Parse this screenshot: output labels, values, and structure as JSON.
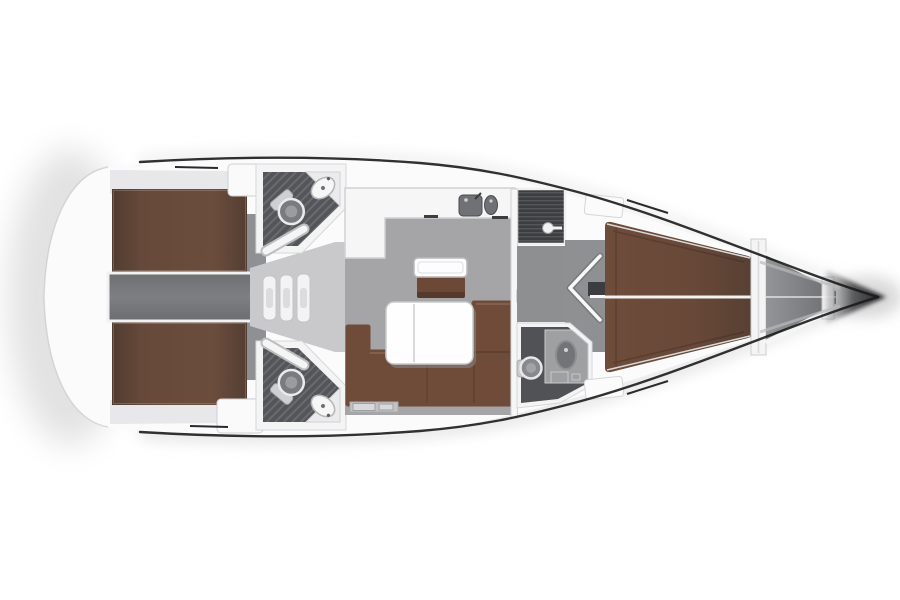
{
  "diagram": {
    "type": "yacht-interior-floor-plan",
    "view": "top-down",
    "bow_direction": "right",
    "rooms": [
      "aft-cabin-port",
      "aft-cabin-starboard",
      "engine-bay",
      "companionway",
      "aft-head-port",
      "aft-head-starboard",
      "salon",
      "galley",
      "forward-head",
      "forward-cabin",
      "anchor-locker"
    ],
    "furniture": [
      "double-berth-aft-port",
      "double-berth-aft-starboard",
      "companionway-steps",
      "toilet",
      "washbasin",
      "galley-sinks",
      "salon-sofa",
      "folding-table",
      "nav-seat",
      "v-berth-forward",
      "cabin-door-open"
    ]
  },
  "colors": {
    "background": "#ffffff",
    "hull": "#fbfbfc",
    "wall": "#f4f4f5",
    "wall_stroke": "#cfd0d2",
    "outline": "#1b1b1b",
    "salon_floor": "#a5a4a6",
    "landing_floor": "#c9c9cb",
    "engine_bay": "#77787b",
    "vestibule_floor": "#8e8f91",
    "forward_floor": "#8f9092",
    "head_floor": "#515255",
    "shower_floor": "#3d3e40",
    "anchor_locker": "#8e8f92",
    "berth_brown": "#64483a",
    "sofa_brown": "#6f4c3a",
    "seat_brown": "#6b4936",
    "table_white": "#fefefe",
    "sink_gray": "#707174",
    "dark_fixture": "#3c3d3f",
    "step_white": "#f4f4f5"
  }
}
